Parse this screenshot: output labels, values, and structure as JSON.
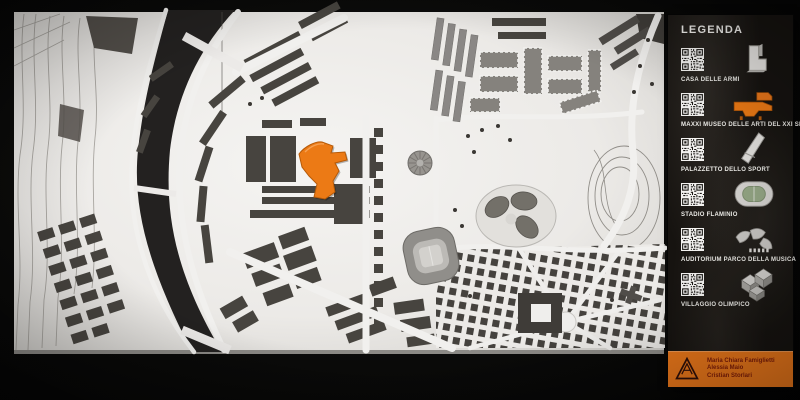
{
  "legend": {
    "title": "LEGENDA",
    "items": [
      {
        "label": "CASA DELLE ARMI",
        "icon": "casa-delle-armi-icon"
      },
      {
        "label": "MAXXI MUSEO DELLE ARTI DEL XXI SEC.",
        "icon": "maxxi-museum-icon",
        "highlight_color": "#e8761a"
      },
      {
        "label": "PALAZZETTO DELLO SPORT",
        "icon": "palazzetto-dello-sport-icon"
      },
      {
        "label": "STADIO FLAMINIO",
        "icon": "stadio-flaminio-icon"
      },
      {
        "label": "AUDITORIUM PARCO DELLA MUSICA",
        "icon": "auditorium-icon"
      },
      {
        "label": "VILLAGGIO OLIMPICO",
        "icon": "villaggio-olimpico-icon"
      }
    ],
    "credits": {
      "names": [
        "Maria Chiara Famiglietti",
        "Alessia Maio",
        "Cristian Storlari"
      ],
      "logo": "am-triangle-logo",
      "background_color": "#e8761a"
    }
  },
  "map": {
    "board_color": "#efeeeb",
    "river_color": "#232120",
    "flat_building_color": "#47443f",
    "model_building_color": "#8d8b87",
    "highlight_color": "#ec7a15"
  }
}
